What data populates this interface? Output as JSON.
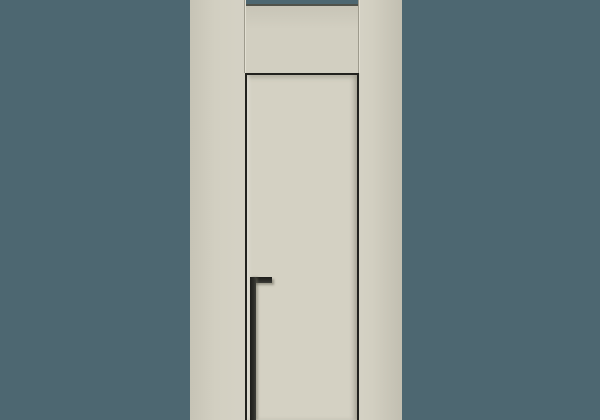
{
  "scene": {
    "title": "Minimalist flush interior door with recessed edge pull",
    "colors": {
      "backdrop": "#4d6771",
      "wall_panel": "#d2cfc1",
      "door_leaf": "#d4d1c3",
      "gap_line": "#22221e",
      "handle": "#2b2b27",
      "top_edge_line": "#50524a",
      "joint_dark": "#9e9b8d",
      "joint_light": "#e2dfd2"
    }
  }
}
